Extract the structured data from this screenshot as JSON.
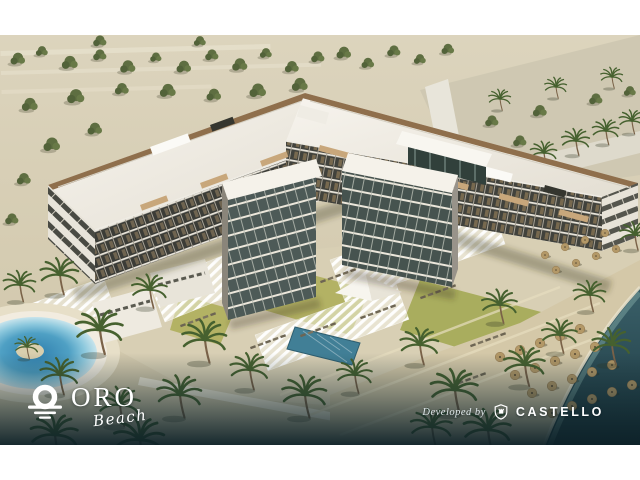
{
  "branding": {
    "oro": {
      "icon": "sun-over-waves-icon",
      "title": "ORO",
      "subtitle": "Beach"
    },
    "developer": {
      "label": "Developed by",
      "icon": "castello-shield-icon",
      "name": "CASTELLO"
    }
  },
  "artwork": {
    "description": "Aerial architectural rendering of a U-shaped beachfront residential resort with white rooftop terraces, balconied facades, landscaped pool courtyard with pergolas, lagoon pool, palm trees, rows of beach umbrellas and teal sea",
    "palette": {
      "canvas": "#ffffff",
      "desert_sand": "#d5ccb2",
      "foliage_green": "#5e6e41",
      "roof_white": "#f4f1ea",
      "facade_dark": "#3b3c37",
      "wood_accent": "#8f6f4c",
      "lawn_green": "#b3b264",
      "pool_blue": "#4fa0c4",
      "sea_teal": "#2b4d56",
      "overlay_teal": "#10272e",
      "umbrella_tan": "#b39867",
      "logo_white": "#ffffff"
    }
  }
}
